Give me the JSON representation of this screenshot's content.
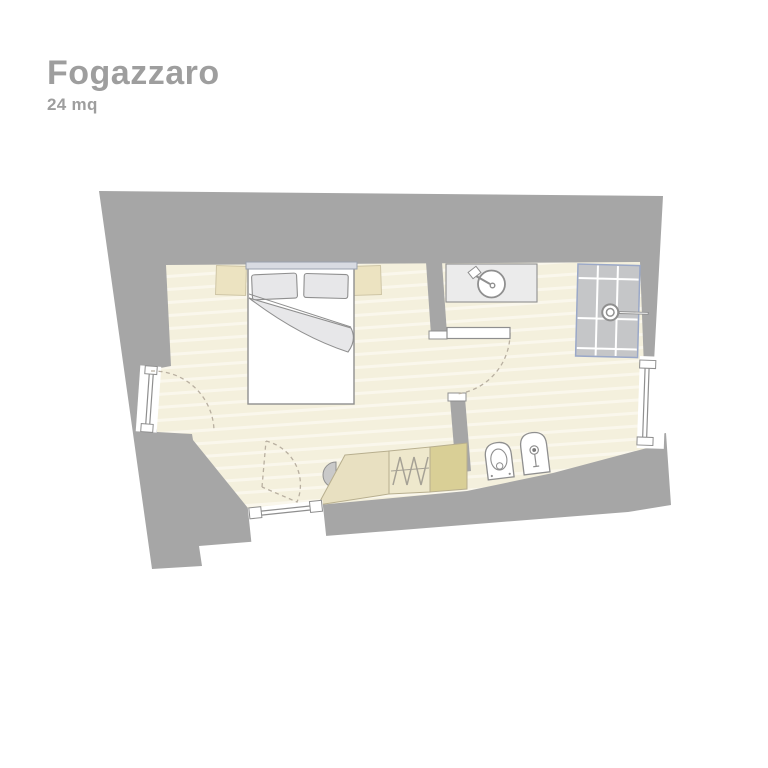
{
  "header": {
    "title": "Fogazzaro",
    "area_label": "24 mq"
  },
  "palette": {
    "bg": "#ffffff",
    "title_text": "#9e9e9e",
    "wall": "#a6a6a6",
    "floor": "#f4f0dd",
    "floor_stripe": "#faf7ec",
    "outline": "#8f8f8f",
    "dash": "#b8afa0",
    "beige": "#ece3c1",
    "beige_edge": "#cfc6a6",
    "tan_light": "#e8e0c1",
    "tan_mid": "#eee8cc",
    "tan_dark": "#d9cf96",
    "tan_edge": "#b7ae8e",
    "soft_gray": "#e7e7e9",
    "headboard": "#d8dbe2",
    "headboard_edge": "#9aa1ae",
    "counter": "#ebebeb",
    "tile": "#c5c6c8",
    "tile_line": "#ffffff",
    "blue_edge": "#9aa8c8",
    "hanger": "#a5a195",
    "stool": "#c9c9c9",
    "white": "#ffffff"
  },
  "plan": {
    "elements": [
      "exterior-walls",
      "bedroom-floor",
      "bathroom-floor",
      "partition-wall",
      "double-bed",
      "pillow-left",
      "pillow-right",
      "duvet-fold",
      "headboard",
      "bedside-table-left",
      "bedside-table-right",
      "wardrobe-corner-unit",
      "wardrobe-hanger-section",
      "wardrobe-end-unit",
      "stool",
      "entrance-french-door",
      "entrance-swing-arc",
      "bedroom-bottom-window",
      "window-swing-arc",
      "interior-door-leaf",
      "interior-door-swing-arc",
      "sink-counter",
      "washbasin",
      "basin-tap",
      "shower-tray",
      "shower-head",
      "toilet",
      "bidet",
      "bathroom-window"
    ]
  }
}
